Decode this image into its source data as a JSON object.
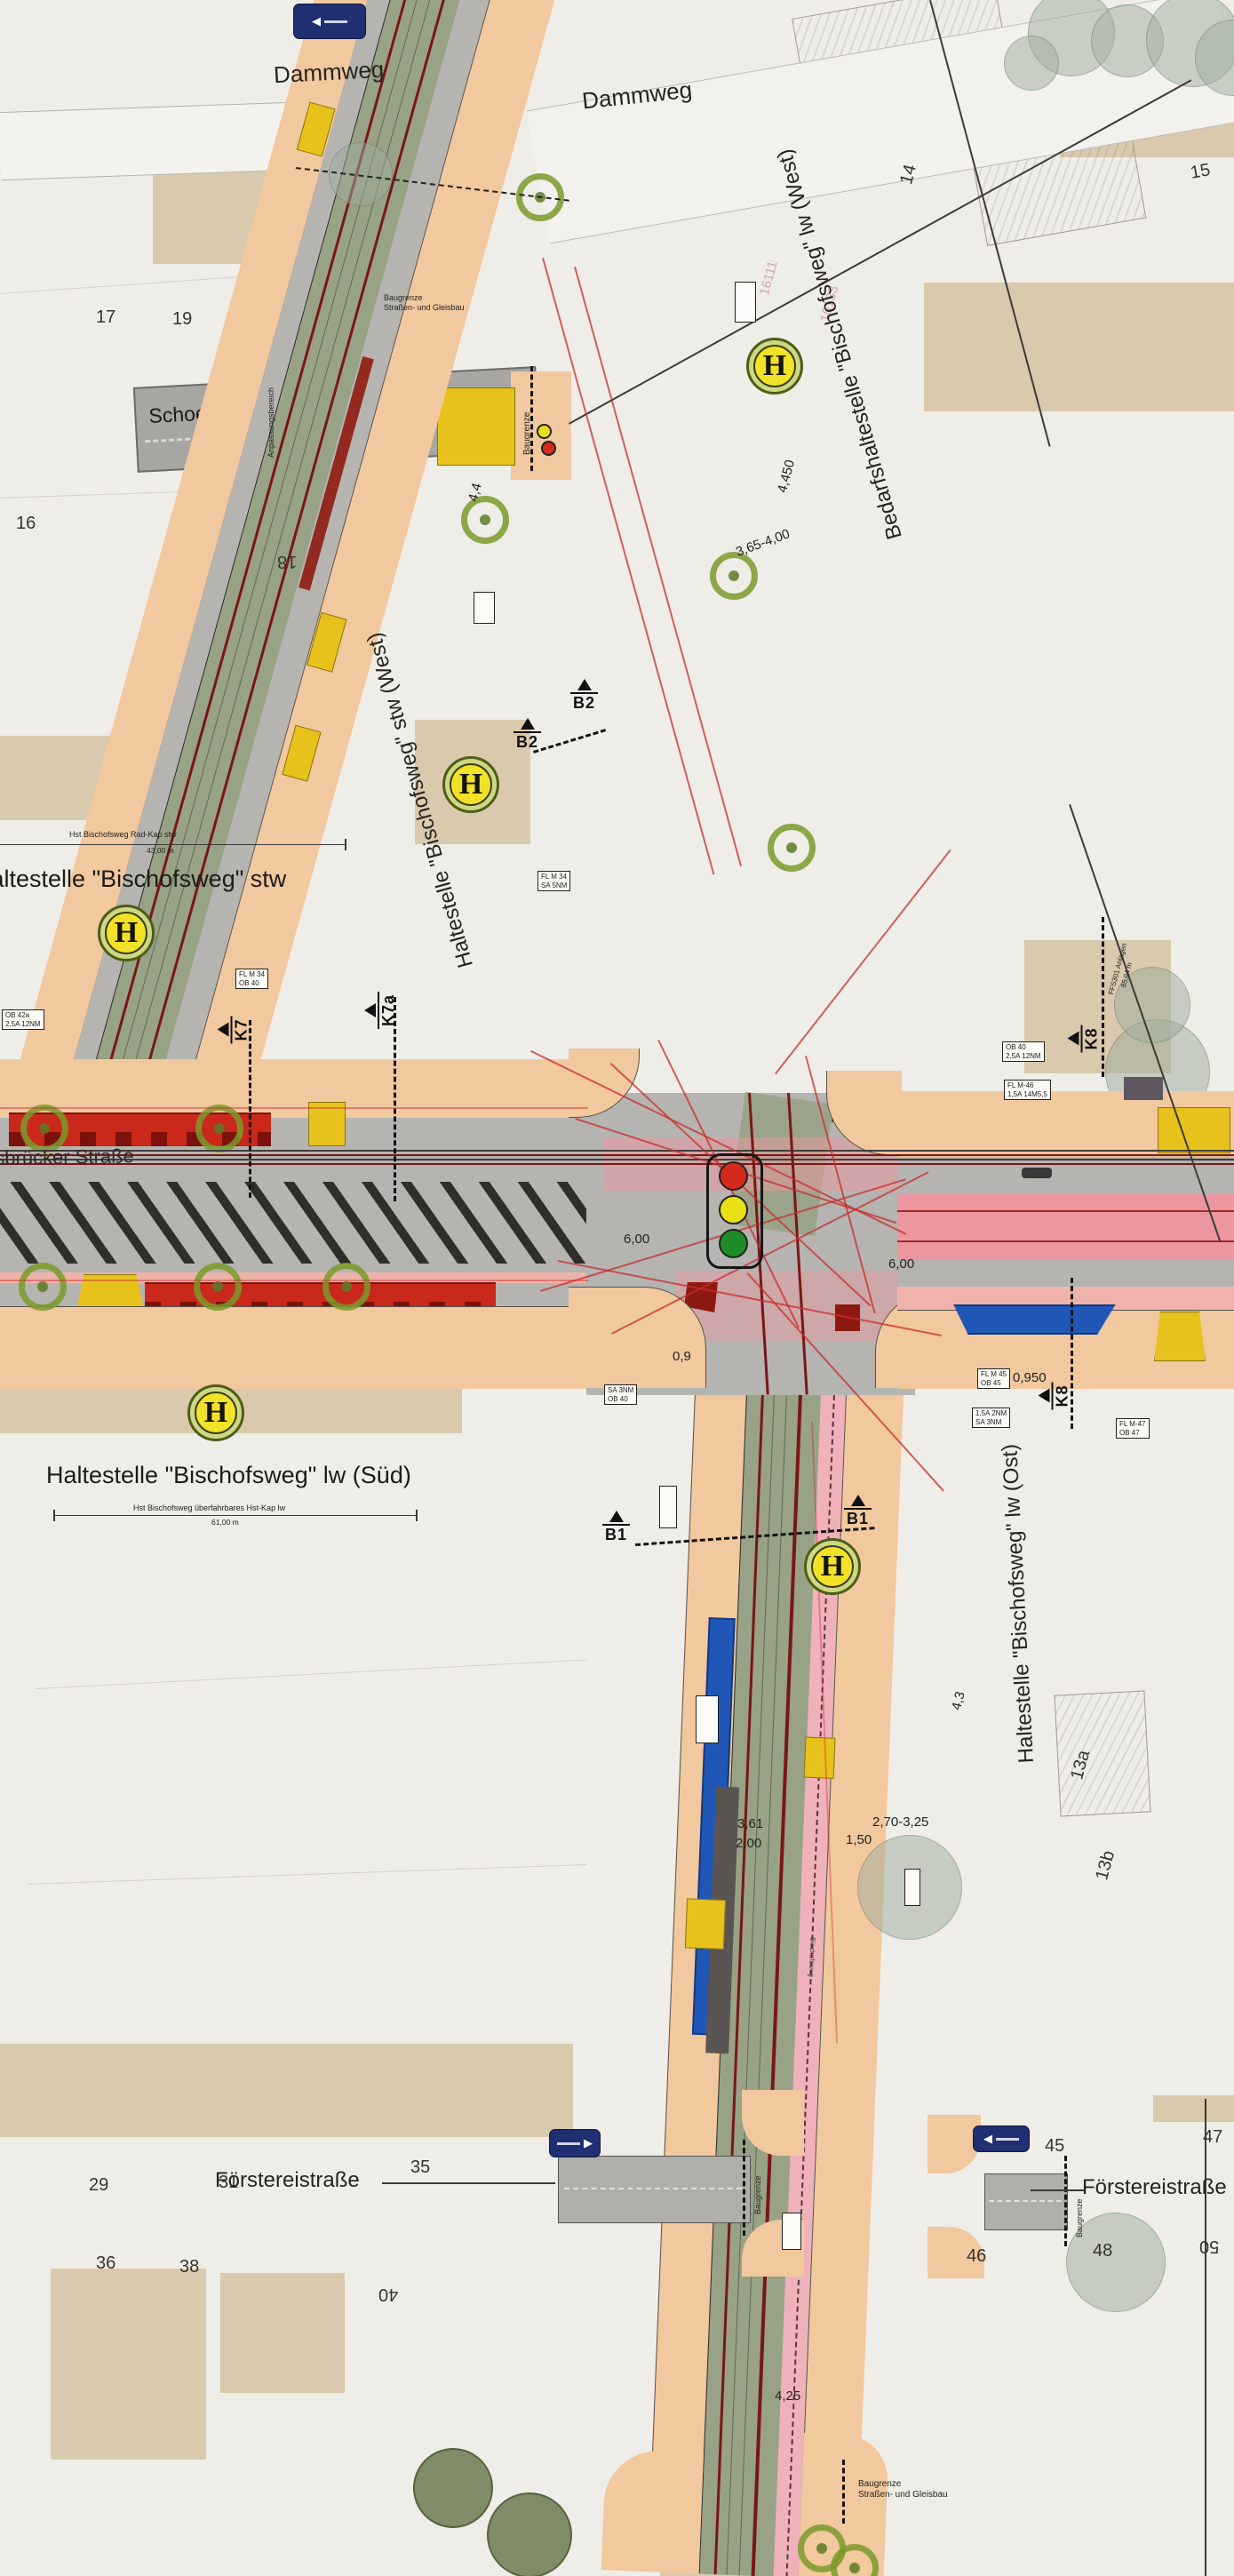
{
  "streets": {
    "dammweg": "Dammweg",
    "schoenbrunn": "Schoenbrunnstraße",
    "koenigsbruecker": "Königsbrücker Straße",
    "bischofsweg": "Bischofsweg",
    "foerstereistrasse": "Förstereistraße"
  },
  "stops": {
    "h_symbol": "H",
    "stw": "Haltestelle \"Bischofsweg\" stw",
    "stw_west": "Haltestelle \"Bischofsweg\" stw (West)",
    "bedarfs_west": "Bedarfshaltestelle \"Bischofsweg\" lw (West)",
    "sued": "Haltestelle \"Bischofsweg\" lw (Süd)",
    "ost": "Haltestelle \"Bischofsweg\" lw (Ost)"
  },
  "measure_lines": {
    "stw_cap": "Hst Bischofsweg Rad-Kap stw",
    "stw_len": "43,00 m",
    "sued_cap": "Hst Bischofsweg überfahrbares Hst-Kap lw",
    "sued_len": "61,00 m",
    "ffs_cap": "FFS301 Anlagen",
    "ffs_len": "85,94 m"
  },
  "boundaries": {
    "baugrenze": "Baugrenze",
    "gleisbau": "Straßen- und Gleisbau",
    "anpassung": "Anpassungsbereich"
  },
  "markers": {
    "b1": "B1",
    "b2": "B2",
    "k7": "K7",
    "k7a": "K7a",
    "k8": "K8"
  },
  "house_numbers": {
    "n13a": "13a",
    "n13b": "13b",
    "n14": "14",
    "n15": "15",
    "n16": "16",
    "n17": "17",
    "n18": "18",
    "n19": "19",
    "n29": "29",
    "n31": "31",
    "n35": "35",
    "n36": "36",
    "n38": "38",
    "n40": "40",
    "n45": "45",
    "n46": "46",
    "n47": "47",
    "n48": "48",
    "n50": "50"
  },
  "dimensions": {
    "d4450": "4,450",
    "d365400": "3,65-4,00",
    "d600": "6,00",
    "d0950": "0,950",
    "d09": "0,9",
    "d270325": "2,70-3,25",
    "d150": "1,50",
    "d200": "2,00",
    "d361": "3,61",
    "d425": "4,25",
    "d44": "4,4",
    "d43": "4,3"
  },
  "parcel_ids": {
    "p1": "16111",
    "p2": "16133"
  },
  "equipment": {
    "fl_m34": "FL  M 34",
    "ob_40": "OB  40",
    "ob_42": "OB  42a",
    "fl_m45": "FL  M 45",
    "ob_45": "OB  45",
    "fl_m46": "FL  M-46",
    "fl_m47": "FL  M-47",
    "ob_47": "OB  47",
    "a_12nm": "2,5A  12NM",
    "a_14m": "1,5A  14M5,5",
    "a_2nm": "1,5A  2NM",
    "sa_5nm": "SA  5NM",
    "sa_3nm": "SA  3NM"
  },
  "signs": {
    "arrow_left": "◀",
    "arrow_right": "▶"
  },
  "colors": {
    "paper": "#efede8",
    "building_tan": "#d7c5a7",
    "sidewalk_peach": "#f2c89e",
    "road_gray": "#b5b4b0",
    "track_olive": "#98a287",
    "rail_dark_red": "#7a1616",
    "platform_red": "#c9281a",
    "accent_yellow": "#e8c21c",
    "zone_blue": "#2057b7",
    "tram_pink": "#ec96a0",
    "tree_green": "#7c9a33",
    "stop_yellow": "#f2e227",
    "signal_red": "#d42a1e",
    "signal_yellow": "#e8e015",
    "signal_green": "#1e8c28",
    "sign_navy": "#202f72"
  }
}
